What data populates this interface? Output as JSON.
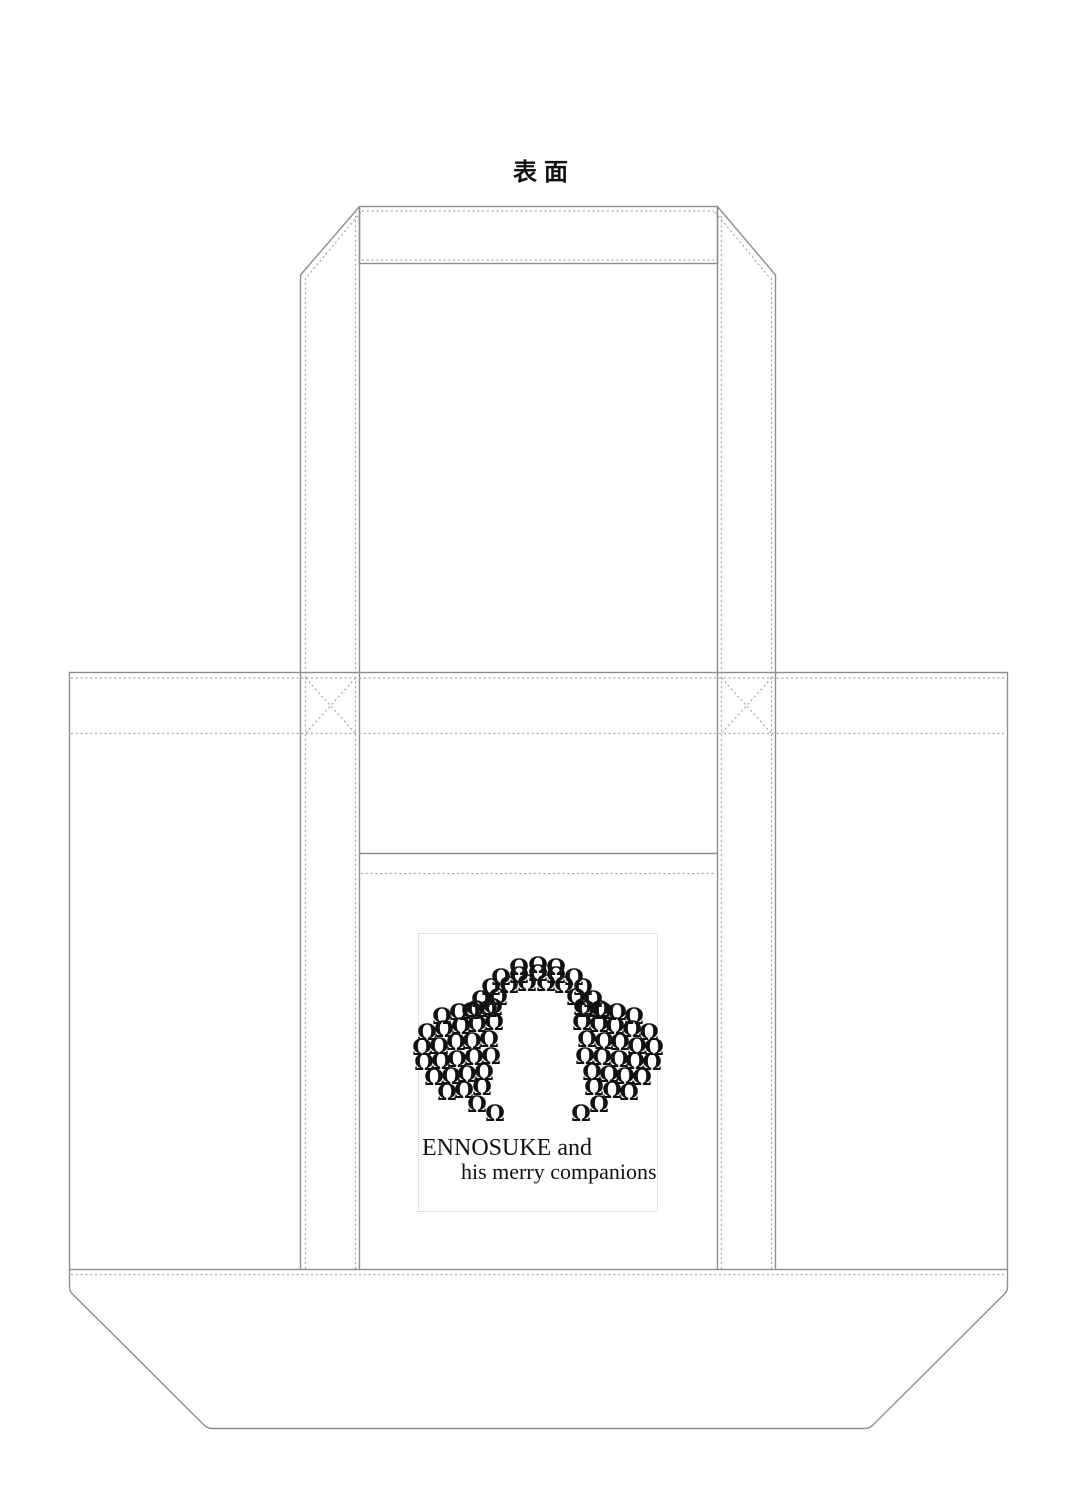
{
  "page": {
    "background": "#ffffff"
  },
  "title": "表面",
  "drawing": {
    "solid_line_color": "#8e8e8e",
    "stitch_line_color": "#a6a6a6",
    "parts": {
      "top_hem_band": "top-hem-band",
      "left_strap": "left-strap",
      "right_strap": "right-strap",
      "bag_body": "bag-body",
      "pocket_seam": "pocket-seam",
      "bottom_gusset": "bottom-gusset",
      "x_stitches": [
        "x-stitch-left",
        "x-stitch-right"
      ]
    }
  },
  "logo": {
    "ink_color": "#111111",
    "line1": "ENNOSUKE and",
    "line2": "his merry companions",
    "figure_glyph": "Ω",
    "figures": [
      [
        100,
        35
      ],
      [
        119,
        33
      ],
      [
        137,
        35
      ],
      [
        82,
        45
      ],
      [
        100,
        43
      ],
      [
        119,
        41
      ],
      [
        137,
        43
      ],
      [
        155,
        45
      ],
      [
        72,
        55
      ],
      [
        90,
        53
      ],
      [
        108,
        51
      ],
      [
        127,
        51
      ],
      [
        145,
        53
      ],
      [
        164,
        55
      ],
      [
        62,
        67
      ],
      [
        79,
        65
      ],
      [
        157,
        65
      ],
      [
        174,
        67
      ],
      [
        52,
        79
      ],
      [
        69,
        77
      ],
      [
        167,
        77
      ],
      [
        184,
        79
      ],
      [
        23,
        84
      ],
      [
        40,
        80
      ],
      [
        57,
        77
      ],
      [
        74,
        75
      ],
      [
        8,
        100
      ],
      [
        25,
        97
      ],
      [
        42,
        94
      ],
      [
        58,
        92
      ],
      [
        75,
        90
      ],
      [
        3,
        115
      ],
      [
        20,
        114
      ],
      [
        37,
        110
      ],
      [
        53,
        109
      ],
      [
        70,
        107
      ],
      [
        5,
        130
      ],
      [
        22,
        129
      ],
      [
        38,
        127
      ],
      [
        55,
        125
      ],
      [
        72,
        124
      ],
      [
        15,
        145
      ],
      [
        32,
        144
      ],
      [
        48,
        142
      ],
      [
        65,
        140
      ],
      [
        28,
        160
      ],
      [
        45,
        158
      ],
      [
        63,
        155
      ],
      [
        58,
        172
      ],
      [
        76,
        181
      ],
      [
        215,
        84
      ],
      [
        198,
        80
      ],
      [
        181,
        77
      ],
      [
        164,
        75
      ],
      [
        230,
        100
      ],
      [
        213,
        97
      ],
      [
        196,
        94
      ],
      [
        180,
        92
      ],
      [
        163,
        90
      ],
      [
        235,
        115
      ],
      [
        218,
        114
      ],
      [
        201,
        110
      ],
      [
        185,
        109
      ],
      [
        168,
        107
      ],
      [
        233,
        130
      ],
      [
        216,
        129
      ],
      [
        200,
        127
      ],
      [
        183,
        125
      ],
      [
        166,
        124
      ],
      [
        223,
        145
      ],
      [
        206,
        144
      ],
      [
        190,
        142
      ],
      [
        173,
        140
      ],
      [
        210,
        160
      ],
      [
        193,
        158
      ],
      [
        175,
        155
      ],
      [
        180,
        172
      ],
      [
        162,
        181
      ]
    ]
  }
}
